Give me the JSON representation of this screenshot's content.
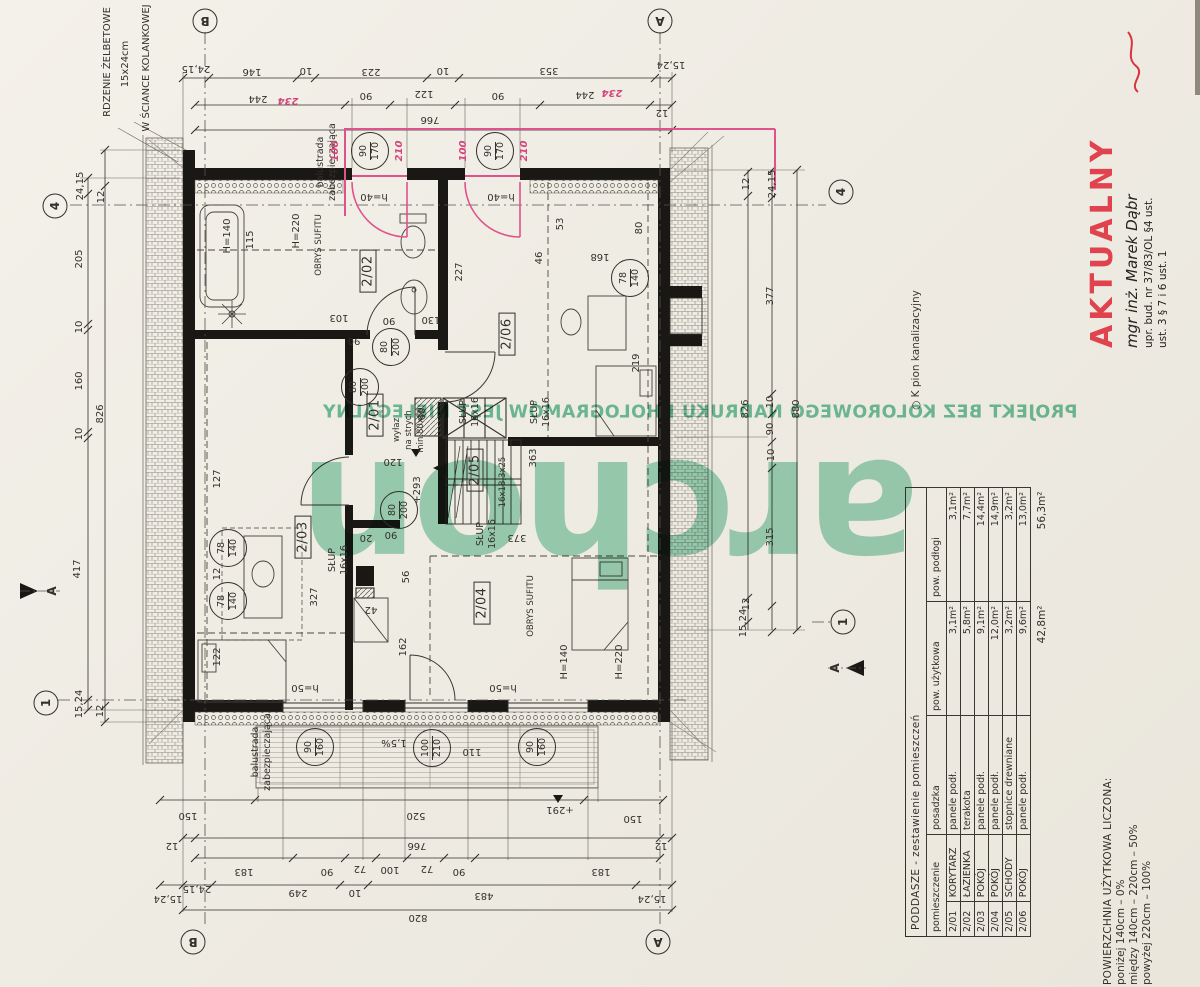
{
  "stamp": {
    "title": "AKTUALNY",
    "engineer": "mgr inż. Marek Dąbr",
    "license1": "upr. bud. nr 37/83/OL §4 ust.",
    "license2": "ust. 3 § 7 i 6 ust. 1"
  },
  "watermark": {
    "logo": "archon",
    "line": "PROJEKT BEZ KOLOROWEGO NADRUKU I HOLOGRAMÓW JEST NIELEGALNY",
    "pion": "○  K pion kanalizacyjny"
  },
  "margin_notes": {
    "rdzenie1": "RDZENIE ŻELBETOWE",
    "rdzenie2": "15x24cm",
    "rdzenie3": "W ŚCIANCE KOLANKOWEJ",
    "balustrada1": "balustrada",
    "balustrada2": "zabezpieczająca"
  },
  "axes": {
    "b": "B",
    "a": "A",
    "n4": "4",
    "n1": "1",
    "section": "A"
  },
  "rooms": {
    "r201": "2/01",
    "r202": "2/02",
    "r203": "2/03",
    "r204": "2/04",
    "r205": "2/05",
    "r206": "2/06"
  },
  "room_notes": {
    "wylaz1": "wyłaz",
    "wylaz2": "na strych",
    "wylaz3": "min.80x80",
    "obrys": "OBRYS SUFITU",
    "slup1": "SŁUP",
    "slup2": "16x16",
    "steps": "16x18,3x25",
    "slope": "1,5%"
  },
  "openings": {
    "d": {
      "t": "80",
      "b": "200"
    },
    "w1": {
      "t": "90",
      "b": "170"
    },
    "w2": {
      "t": "78",
      "b": "140"
    },
    "w3": {
      "t": "90",
      "b": "160"
    },
    "w4": {
      "t": "100",
      "b": "210"
    }
  },
  "pink": {
    "p100": "100",
    "p210": "210",
    "p234": "234"
  },
  "dims": {
    "top1": [
      "24,15",
      "146",
      "10",
      "223",
      "10",
      "353",
      "15,24"
    ],
    "top2": [
      "244",
      "90",
      "122",
      "90",
      "244",
      "12"
    ],
    "top3": [
      "766"
    ],
    "bot1": [
      "150",
      "520",
      "+291",
      "150"
    ],
    "bot2": [
      "12",
      "766",
      "12"
    ],
    "bot3": [
      "183",
      "90",
      "72",
      "100",
      "72",
      "90",
      "183"
    ],
    "bot4": [
      "15,24",
      "24,15",
      "249",
      "10",
      "483",
      "15,24"
    ],
    "bot5": [
      "820"
    ],
    "left": [
      "24,15",
      "205",
      "10",
      "160",
      "10",
      "417",
      "15,24",
      "12",
      "826",
      "12"
    ],
    "right": [
      "12",
      "826",
      "12",
      "24,15",
      "377",
      "10",
      "90",
      "10",
      "315",
      "15,24",
      "880"
    ],
    "inner": {
      "i227": "227",
      "i46": "46",
      "i53": "53",
      "i80": "80",
      "i168": "168",
      "i219": "219",
      "i130": "130",
      "i90": "90",
      "i90b": "90",
      "i90c": "90",
      "i103": "103",
      "i115": "115",
      "i120": "120",
      "i363": "363",
      "i373": "373",
      "i327": "327",
      "i12": "12",
      "i127": "127",
      "i122": "122",
      "i42": "42",
      "i20": "20",
      "i56": "56",
      "i162": "162",
      "i110": "110",
      "i60": "60",
      "h140": "H=140",
      "h220": "H=220",
      "h40": "h=40",
      "h50": "h=50",
      "lvl293": "+293"
    }
  },
  "table": {
    "title": "PODDASZE  -  zestawienie pomieszczeń",
    "headers": {
      "room": "pomieszczenie",
      "floor": "posadzka",
      "use": "pow. użytkowa",
      "pod": "pow. podłogi"
    },
    "rows": [
      {
        "no": "2/01",
        "name": "KORYTARZ",
        "floor": "panele podł.",
        "use": "3,1m²",
        "pod": "3,1m²"
      },
      {
        "no": "2/02",
        "name": "ŁAZIENKA",
        "floor": "terakota",
        "use": "5,8m²",
        "pod": "7,7m²"
      },
      {
        "no": "2/03",
        "name": "POKÓJ",
        "floor": "panele podł.",
        "use": "9,1m²",
        "pod": "14,4m²"
      },
      {
        "no": "2/04",
        "name": "POKÓJ",
        "floor": "panele podł.",
        "use": "12,0m²",
        "pod": "14,9m²"
      },
      {
        "no": "2/05",
        "name": "SCHODY",
        "floor": "stopnice drewniane",
        "use": "3,2m²",
        "pod": "3,2m²"
      },
      {
        "no": "2/06",
        "name": "POKÓJ",
        "floor": "panele podł.",
        "use": "9,6m²",
        "pod": "13,0m²"
      }
    ],
    "total": {
      "use": "42,8m²",
      "pod": "56,3m²"
    }
  },
  "notes": {
    "title": "POWIERZCHNIA  UŻYTKOWA  LICZONA:",
    "line1": "poniżej  140cm  –  0%",
    "line2": "między  140cm  –  220cm   –   50%",
    "line3": "powyżej  220cm  –  100%"
  }
}
